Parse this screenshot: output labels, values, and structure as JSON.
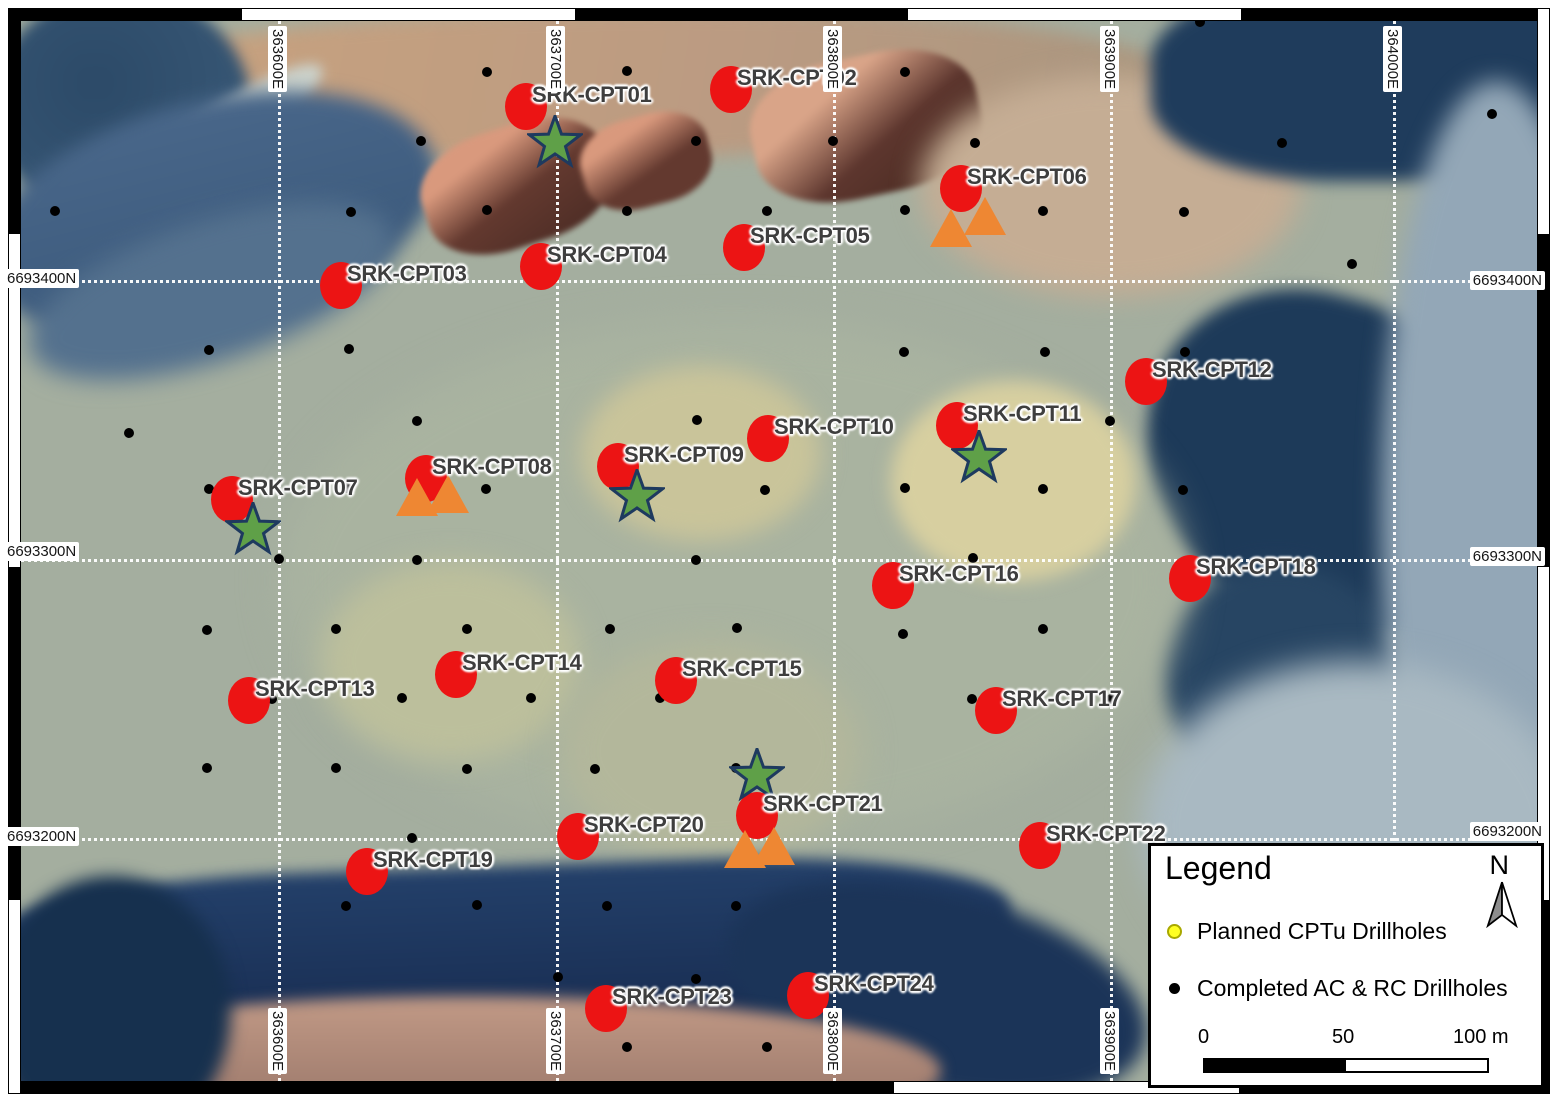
{
  "map": {
    "grid": {
      "x_lines": [
        278,
        556,
        833,
        1110,
        1393
      ],
      "y_lines": [
        280,
        559,
        838
      ],
      "edge_labels": [
        {
          "text": "363600E",
          "edge": "top",
          "pos": 278
        },
        {
          "text": "363700E",
          "edge": "top",
          "pos": 556
        },
        {
          "text": "363800E",
          "edge": "top",
          "pos": 833
        },
        {
          "text": "363900E",
          "edge": "top",
          "pos": 1110
        },
        {
          "text": "364000E",
          "edge": "top",
          "pos": 1393
        },
        {
          "text": "363600E",
          "edge": "bottom",
          "pos": 278
        },
        {
          "text": "363700E",
          "edge": "bottom",
          "pos": 556
        },
        {
          "text": "363800E",
          "edge": "bottom",
          "pos": 833
        },
        {
          "text": "363900E",
          "edge": "bottom",
          "pos": 1110
        },
        {
          "text": "6693400N",
          "edge": "left",
          "pos": 280
        },
        {
          "text": "6693300N",
          "edge": "left",
          "pos": 553
        },
        {
          "text": "6693200N",
          "edge": "left",
          "pos": 838
        },
        {
          "text": "6693400N",
          "edge": "right",
          "pos": 282
        },
        {
          "text": "6693300N",
          "edge": "right",
          "pos": 558
        },
        {
          "text": "6693200N",
          "edge": "right",
          "pos": 833
        }
      ]
    },
    "planned_cptu_markers": [
      {
        "id": "SRK-CPT01",
        "x": 526,
        "y": 106
      },
      {
        "id": "SRK-CPT02",
        "x": 731,
        "y": 89
      },
      {
        "id": "SRK-CPT03",
        "x": 341,
        "y": 285
      },
      {
        "id": "SRK-CPT04",
        "x": 541,
        "y": 266
      },
      {
        "id": "SRK-CPT05",
        "x": 744,
        "y": 247
      },
      {
        "id": "SRK-CPT06",
        "x": 961,
        "y": 188
      },
      {
        "id": "SRK-CPT07",
        "x": 232,
        "y": 499
      },
      {
        "id": "SRK-CPT08",
        "x": 426,
        "y": 478
      },
      {
        "id": "SRK-CPT09",
        "x": 618,
        "y": 466
      },
      {
        "id": "SRK-CPT10",
        "x": 768,
        "y": 438
      },
      {
        "id": "SRK-CPT11",
        "x": 957,
        "y": 425
      },
      {
        "id": "SRK-CPT12",
        "x": 1146,
        "y": 381
      },
      {
        "id": "SRK-CPT13",
        "x": 249,
        "y": 700
      },
      {
        "id": "SRK-CPT14",
        "x": 456,
        "y": 674
      },
      {
        "id": "SRK-CPT15",
        "x": 676,
        "y": 680
      },
      {
        "id": "SRK-CPT16",
        "x": 893,
        "y": 585
      },
      {
        "id": "SRK-CPT17",
        "x": 996,
        "y": 710
      },
      {
        "id": "SRK-CPT18",
        "x": 1190,
        "y": 578
      },
      {
        "id": "SRK-CPT19",
        "x": 367,
        "y": 871
      },
      {
        "id": "SRK-CPT20",
        "x": 578,
        "y": 836
      },
      {
        "id": "SRK-CPT21",
        "x": 757,
        "y": 815
      },
      {
        "id": "SRK-CPT22",
        "x": 1040,
        "y": 845
      },
      {
        "id": "SRK-CPT23",
        "x": 606,
        "y": 1008
      },
      {
        "id": "SRK-CPT24",
        "x": 808,
        "y": 995
      }
    ],
    "star_markers": [
      {
        "x": 555,
        "y": 143
      },
      {
        "x": 253,
        "y": 530
      },
      {
        "x": 637,
        "y": 497
      },
      {
        "x": 979,
        "y": 458
      },
      {
        "x": 757,
        "y": 776
      }
    ],
    "triangle_markers": [
      {
        "x": 951,
        "y": 228
      },
      {
        "x": 985,
        "y": 216
      },
      {
        "x": 417,
        "y": 497
      },
      {
        "x": 448,
        "y": 494
      },
      {
        "x": 745,
        "y": 849
      },
      {
        "x": 774,
        "y": 846
      }
    ],
    "completed_drillholes": [
      [
        487,
        72
      ],
      [
        627,
        71
      ],
      [
        905,
        72
      ],
      [
        1200,
        22
      ],
      [
        421,
        141
      ],
      [
        696,
        141
      ],
      [
        833,
        141
      ],
      [
        975,
        143
      ],
      [
        1282,
        143
      ],
      [
        1492,
        114
      ],
      [
        55,
        211
      ],
      [
        351,
        212
      ],
      [
        487,
        210
      ],
      [
        627,
        211
      ],
      [
        767,
        211
      ],
      [
        905,
        210
      ],
      [
        1043,
        211
      ],
      [
        1184,
        212
      ],
      [
        1352,
        264
      ],
      [
        209,
        350
      ],
      [
        349,
        349
      ],
      [
        904,
        352
      ],
      [
        1045,
        352
      ],
      [
        1185,
        352
      ],
      [
        129,
        433
      ],
      [
        417,
        421
      ],
      [
        697,
        420
      ],
      [
        1110,
        421
      ],
      [
        209,
        489
      ],
      [
        347,
        488
      ],
      [
        486,
        489
      ],
      [
        765,
        490
      ],
      [
        905,
        488
      ],
      [
        1043,
        489
      ],
      [
        1183,
        490
      ],
      [
        279,
        559
      ],
      [
        417,
        560
      ],
      [
        696,
        560
      ],
      [
        973,
        558
      ],
      [
        207,
        630
      ],
      [
        336,
        629
      ],
      [
        467,
        629
      ],
      [
        610,
        629
      ],
      [
        737,
        628
      ],
      [
        903,
        634
      ],
      [
        1043,
        629
      ],
      [
        272,
        699
      ],
      [
        402,
        698
      ],
      [
        531,
        698
      ],
      [
        660,
        698
      ],
      [
        972,
        699
      ],
      [
        1111,
        699
      ],
      [
        207,
        768
      ],
      [
        336,
        768
      ],
      [
        467,
        769
      ],
      [
        595,
        769
      ],
      [
        736,
        768
      ],
      [
        412,
        838
      ],
      [
        346,
        906
      ],
      [
        477,
        905
      ],
      [
        607,
        906
      ],
      [
        736,
        906
      ],
      [
        558,
        977
      ],
      [
        696,
        979
      ],
      [
        627,
        1047
      ],
      [
        767,
        1047
      ]
    ]
  },
  "legend": {
    "title": "Legend",
    "north_label": "N",
    "items": [
      {
        "type": "planned",
        "label": "Planned CPTu Drillholes"
      },
      {
        "type": "completed",
        "label": "Completed AC & RC Drillholes"
      }
    ],
    "scale_bar": {
      "tick_labels": [
        "0",
        "50",
        "100 m"
      ]
    }
  },
  "colors": {
    "planned_marker_red": "#ec1414",
    "star_green": "#5fa048",
    "star_outline": "#1e3a5f",
    "triangle_orange": "#ee8733",
    "legend_planned_yellow": "#ffff22",
    "completed_dot_black": "#000000",
    "gridline_white": "#ffffff"
  }
}
